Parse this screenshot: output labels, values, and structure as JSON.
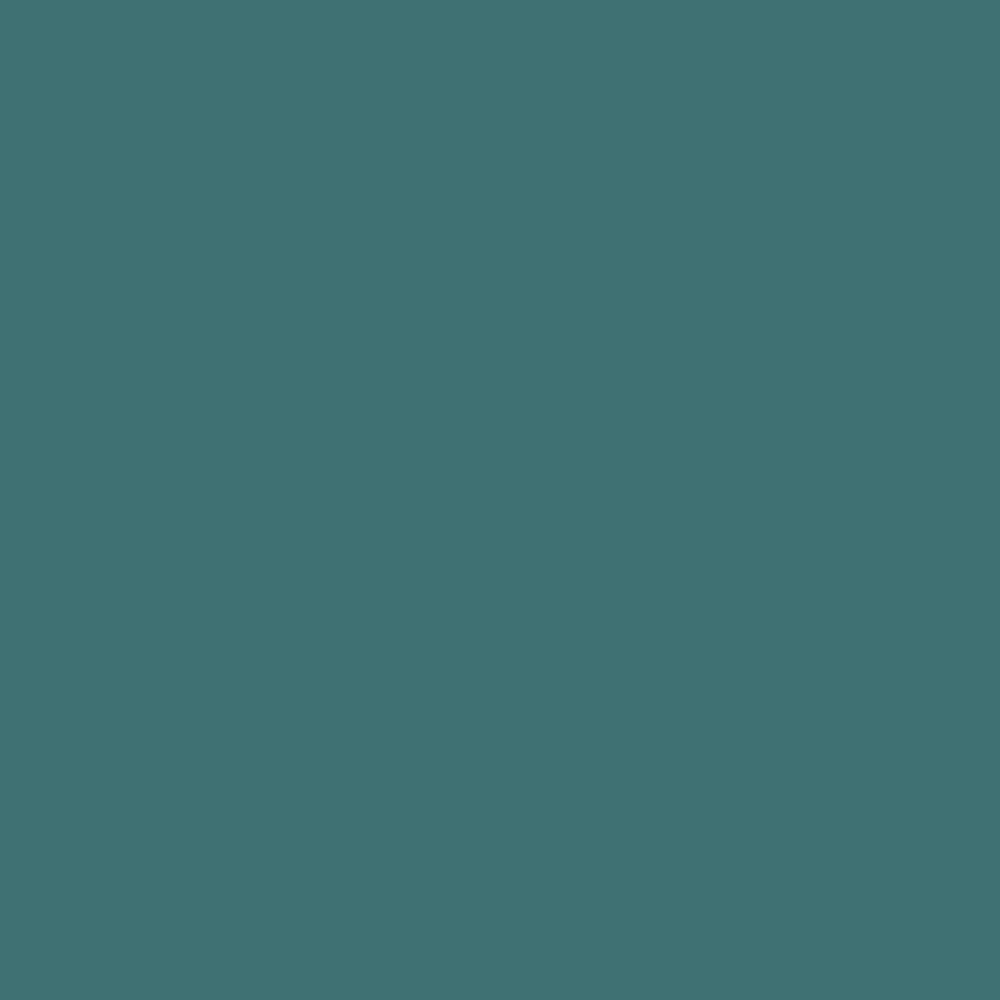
{
  "colors": {
    "background": "#3F7173"
  },
  "background": {
    "style": "background-color:#3F7173;"
  }
}
